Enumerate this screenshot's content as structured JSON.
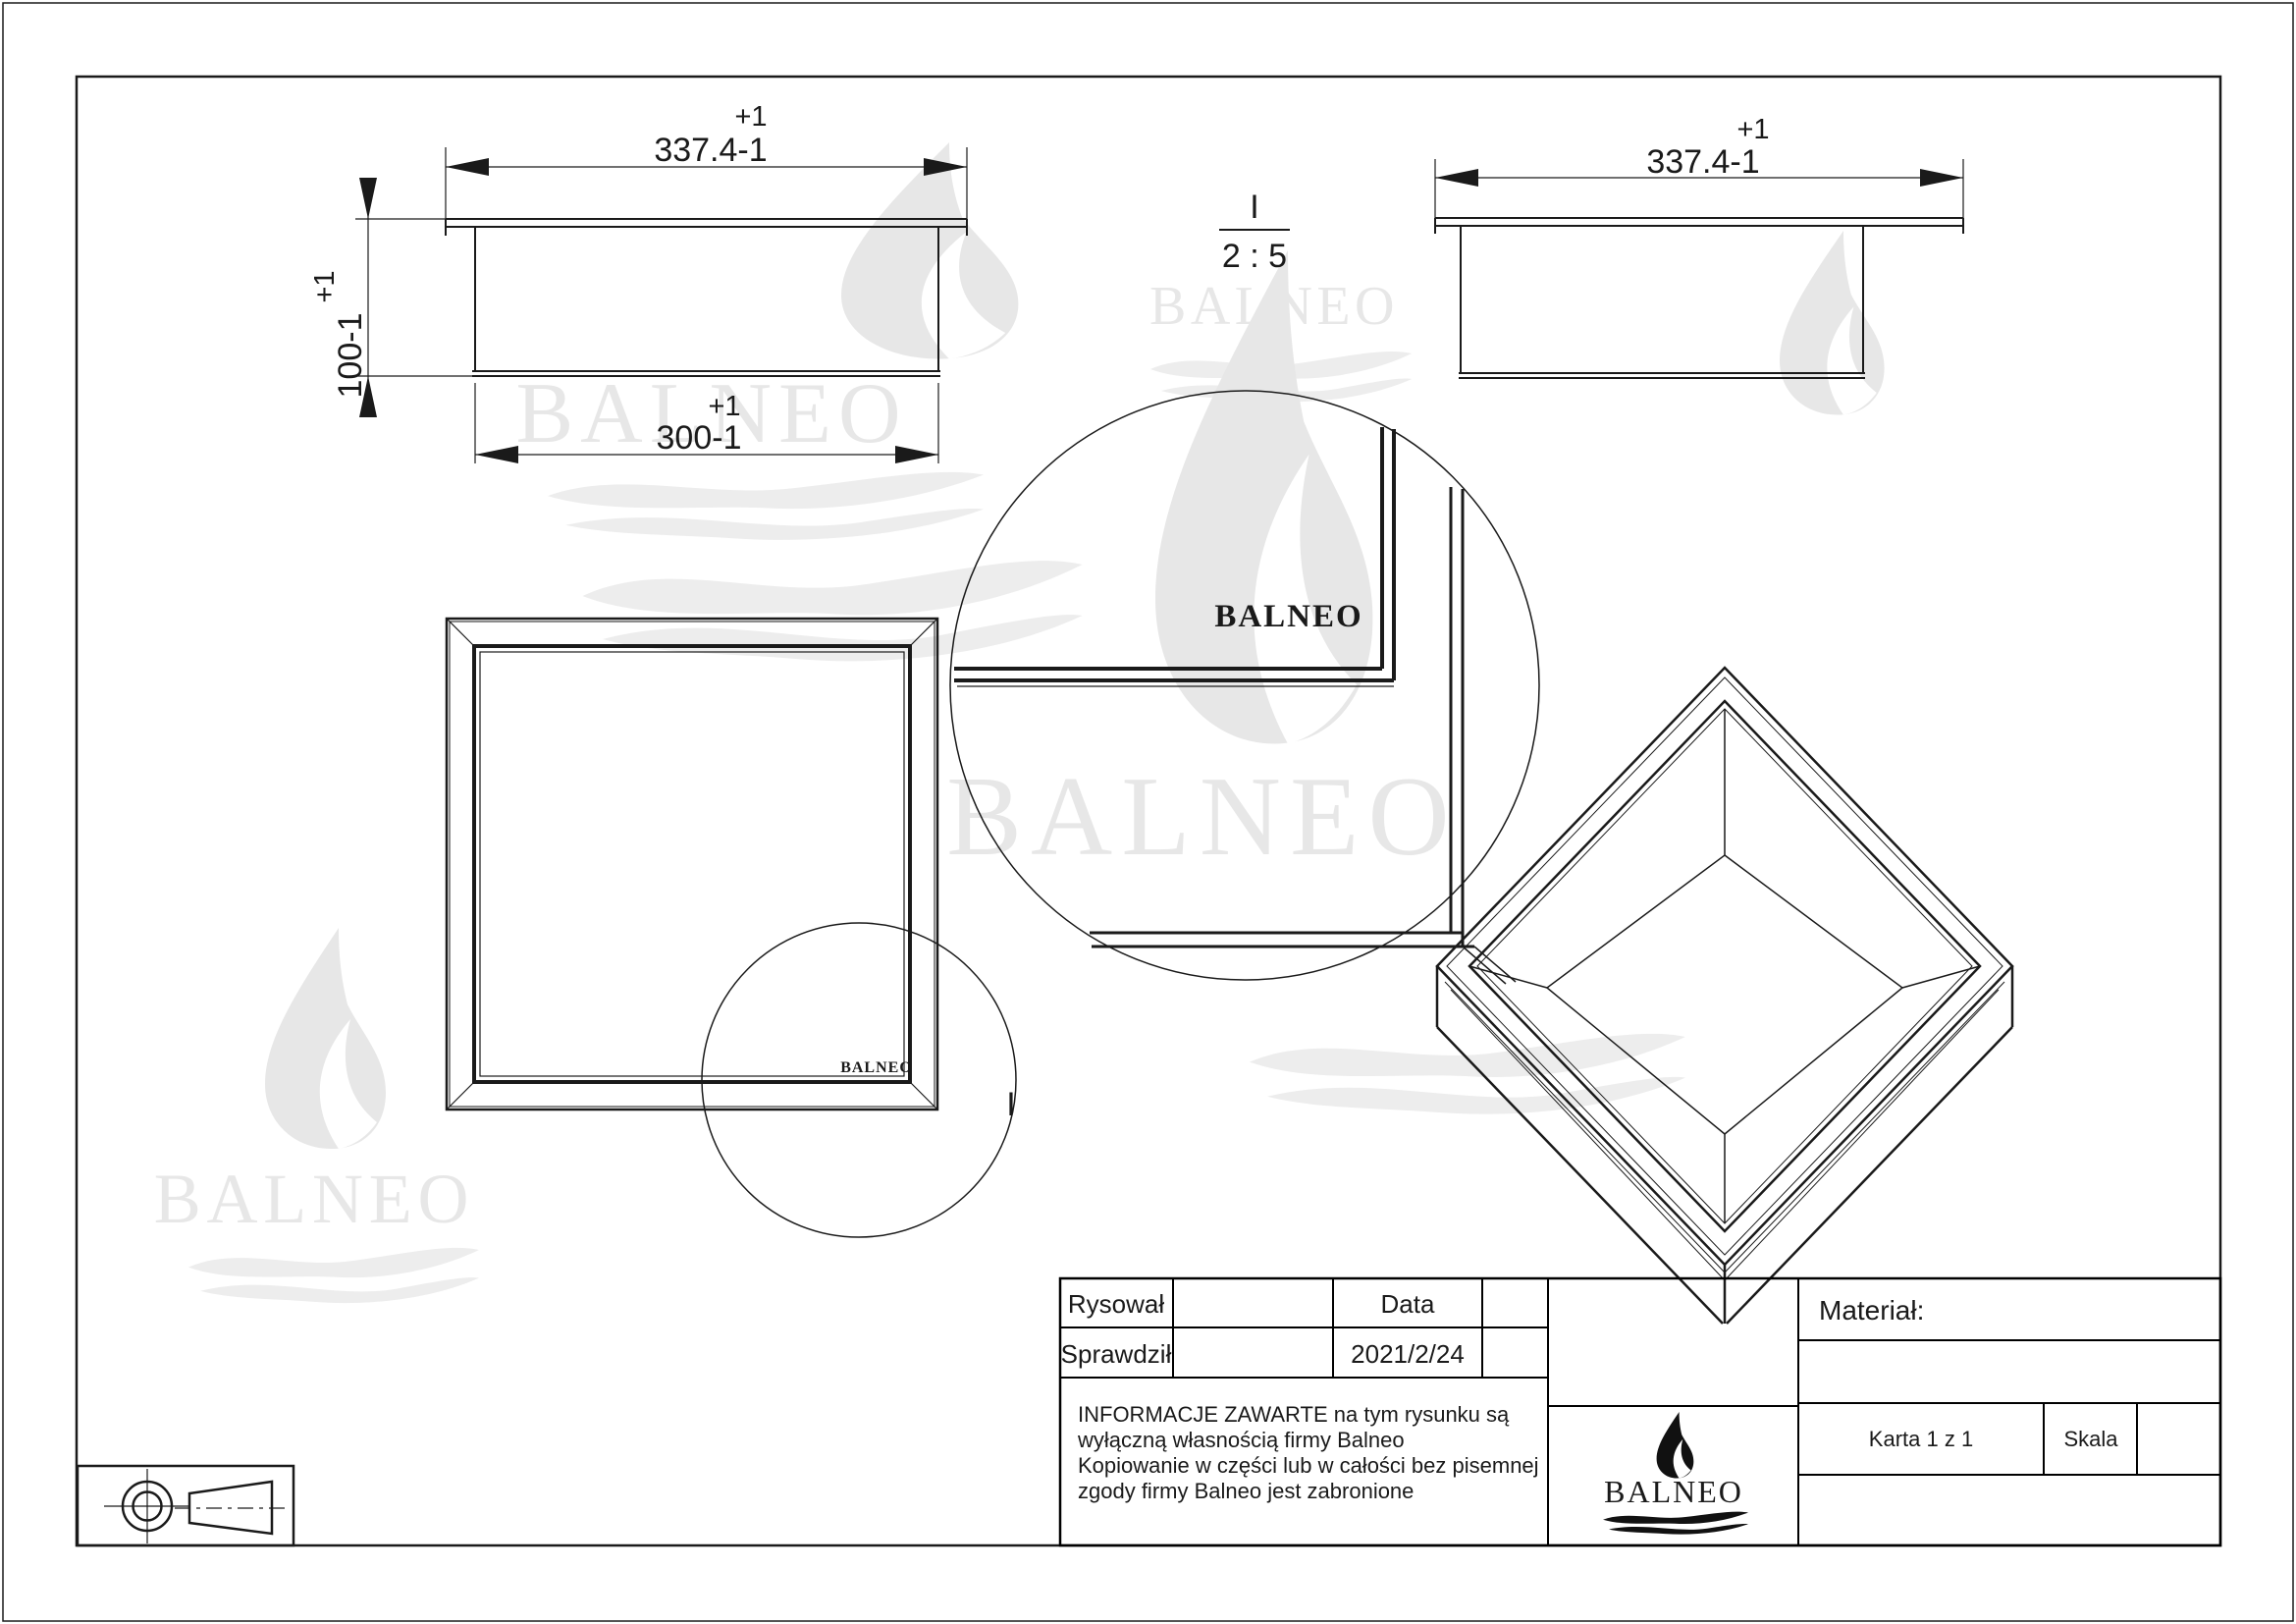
{
  "drawing": {
    "front_view": {
      "width_tol": "+1",
      "width_dim": "337.4-1",
      "height_tol": "+1",
      "height_dim": "100-1",
      "inner_tol": "+1",
      "inner_dim": "300-1"
    },
    "side_view": {
      "width_tol": "+1",
      "width_dim": "337.4-1"
    },
    "detail_ref": {
      "label": "I",
      "scale": "2 : 5"
    },
    "top_view": {
      "detail_label": "I",
      "logo": "BALNEO"
    },
    "detail_view": {
      "logo": "BALNEO"
    },
    "watermark_text": "BALNEO"
  },
  "title_block": {
    "drew_label": "Rysował",
    "checked_label": "Sprawdził",
    "date_label": "Data",
    "date_value": "2021/2/24",
    "notice_lines": [
      "INFORMACJE ZAWARTE na tym rysunku są",
      "wyłączną własnością firmy Balneo",
      "Kopiowanie w części lub w całości bez pisemnej",
      "zgody firmy Balneo jest zabronione"
    ],
    "material_label": "Materiał:",
    "sheet_label": "Karta 1 z 1",
    "scale_label": "Skala",
    "logo_text": "BALNEO"
  },
  "colors": {
    "line": "#1a1a1a",
    "watermark": "#e7e7e7",
    "watermark_light": "#ededed",
    "background": "#ffffff"
  }
}
